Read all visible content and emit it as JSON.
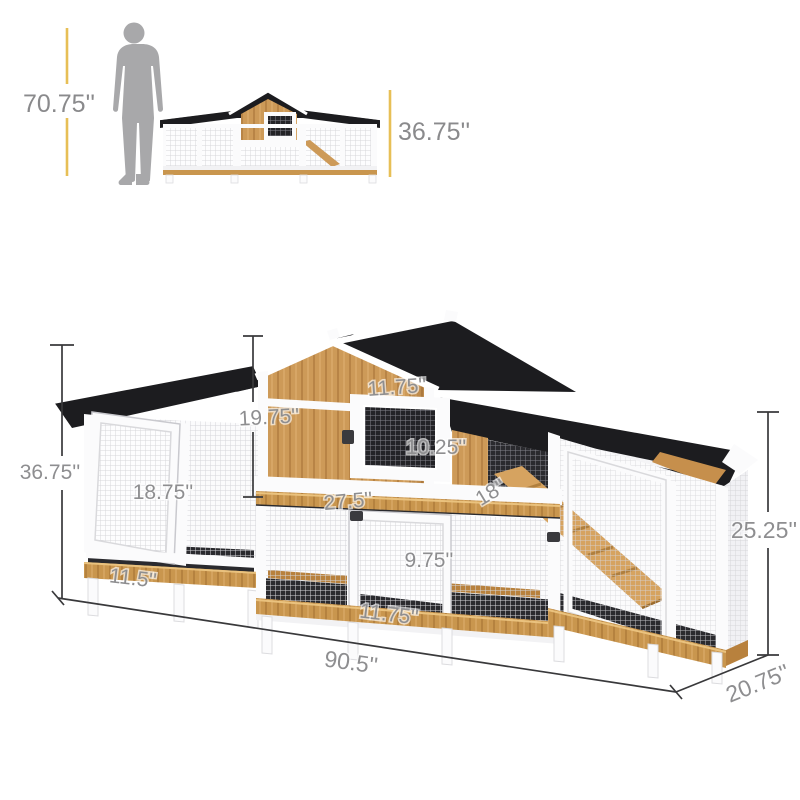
{
  "title": "Rabbit hutch chicken coop dimension diagram",
  "colors": {
    "accent_yellow": "#e7bf56",
    "roof_black": "#1c1c1f",
    "wood_tan": "#cd9a58",
    "wood_dark": "#b8813d",
    "frame_white": "#fbfbfc",
    "mesh_gray": "#d6d6da",
    "interior_dark": "#2a2a2e",
    "dimension_text": "#8e8e90",
    "silhouette_gray": "#a8a8aa",
    "dimension_line": "#39393b"
  },
  "scale_figure": {
    "person_height_label": "70.75''",
    "thumbnail_height_label": "36.75''"
  },
  "main_dimensions": {
    "overall_height": "36.75''",
    "house_height": "19.75''",
    "window_width": "11.75''",
    "window_height": "10.25''",
    "left_door_height": "18.75''",
    "house_width": "27.5''",
    "ramp_length": "18''",
    "run_door_height": "9.75''",
    "left_base_width": "11.5''",
    "run_door_width": "11.75''",
    "overall_width": "90.5''",
    "right_height": "25.25''",
    "overall_depth": "20.75''"
  }
}
